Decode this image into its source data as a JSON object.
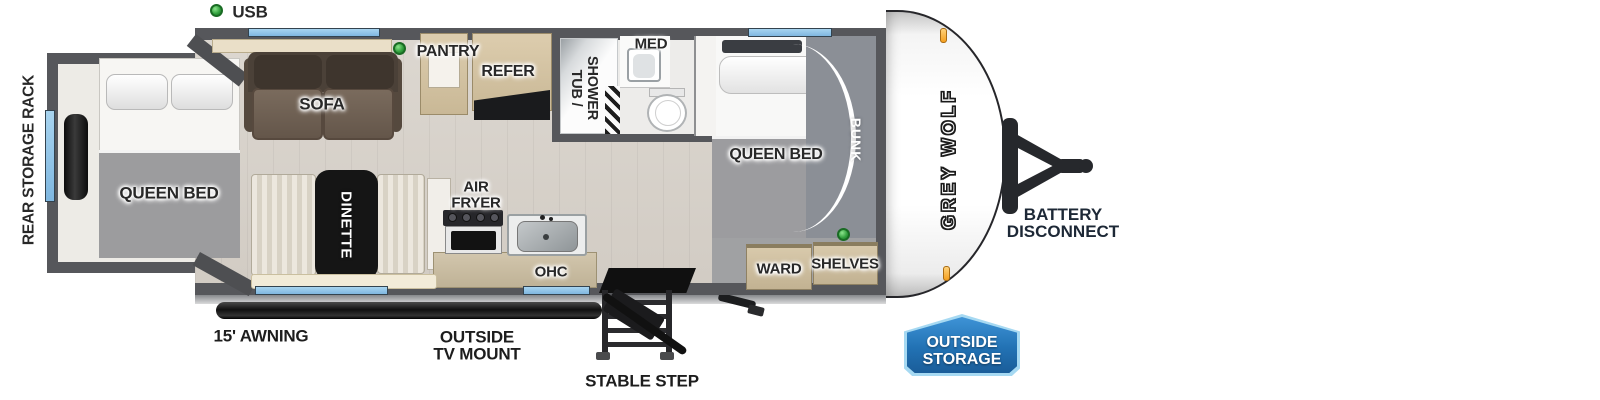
{
  "legend": {
    "usb": "USB"
  },
  "exterior": {
    "rear_storage_rack": "REAR STORAGE RACK",
    "awning": "15' AWNING",
    "outside_tv_mount": [
      "OUTSIDE",
      "TV MOUNT"
    ],
    "stable_step": "STABLE STEP",
    "battery_disconnect": [
      "BATTERY",
      "DISCONNECT"
    ],
    "outside_storage": [
      "OUTSIDE",
      "STORAGE"
    ],
    "brand": "GREY WOLF"
  },
  "rooms": {
    "rear_bedroom": {
      "queen_bed": "QUEEN BED"
    },
    "living": {
      "sofa": "SOFA",
      "dinette": "DINETTE"
    },
    "kitchen": {
      "pantry": "PANTRY",
      "refer": "REFER",
      "air_fryer": [
        "AIR",
        "FRYER"
      ],
      "ohc": "OHC"
    },
    "bath": {
      "tub_shower": [
        "TUB /",
        "SHOWER"
      ],
      "med": "MED"
    },
    "front_bedroom": {
      "queen_bed": "QUEEN BED",
      "bunk": "BUNK",
      "ward": "WARD",
      "shelves": "SHELVES"
    }
  },
  "colors": {
    "wall_gray": "#56575b",
    "window_blue": "#8fc3e8",
    "usb_green": "#2f9e3b",
    "sofa_brown": "#6e6052",
    "cabinet_tan": "#d6c4a4",
    "floor_beige": "#d9d4cd",
    "badge_blue": "#2272b4",
    "badge_border": "#a6d9f2",
    "marker_orange": "#f59f1e"
  }
}
